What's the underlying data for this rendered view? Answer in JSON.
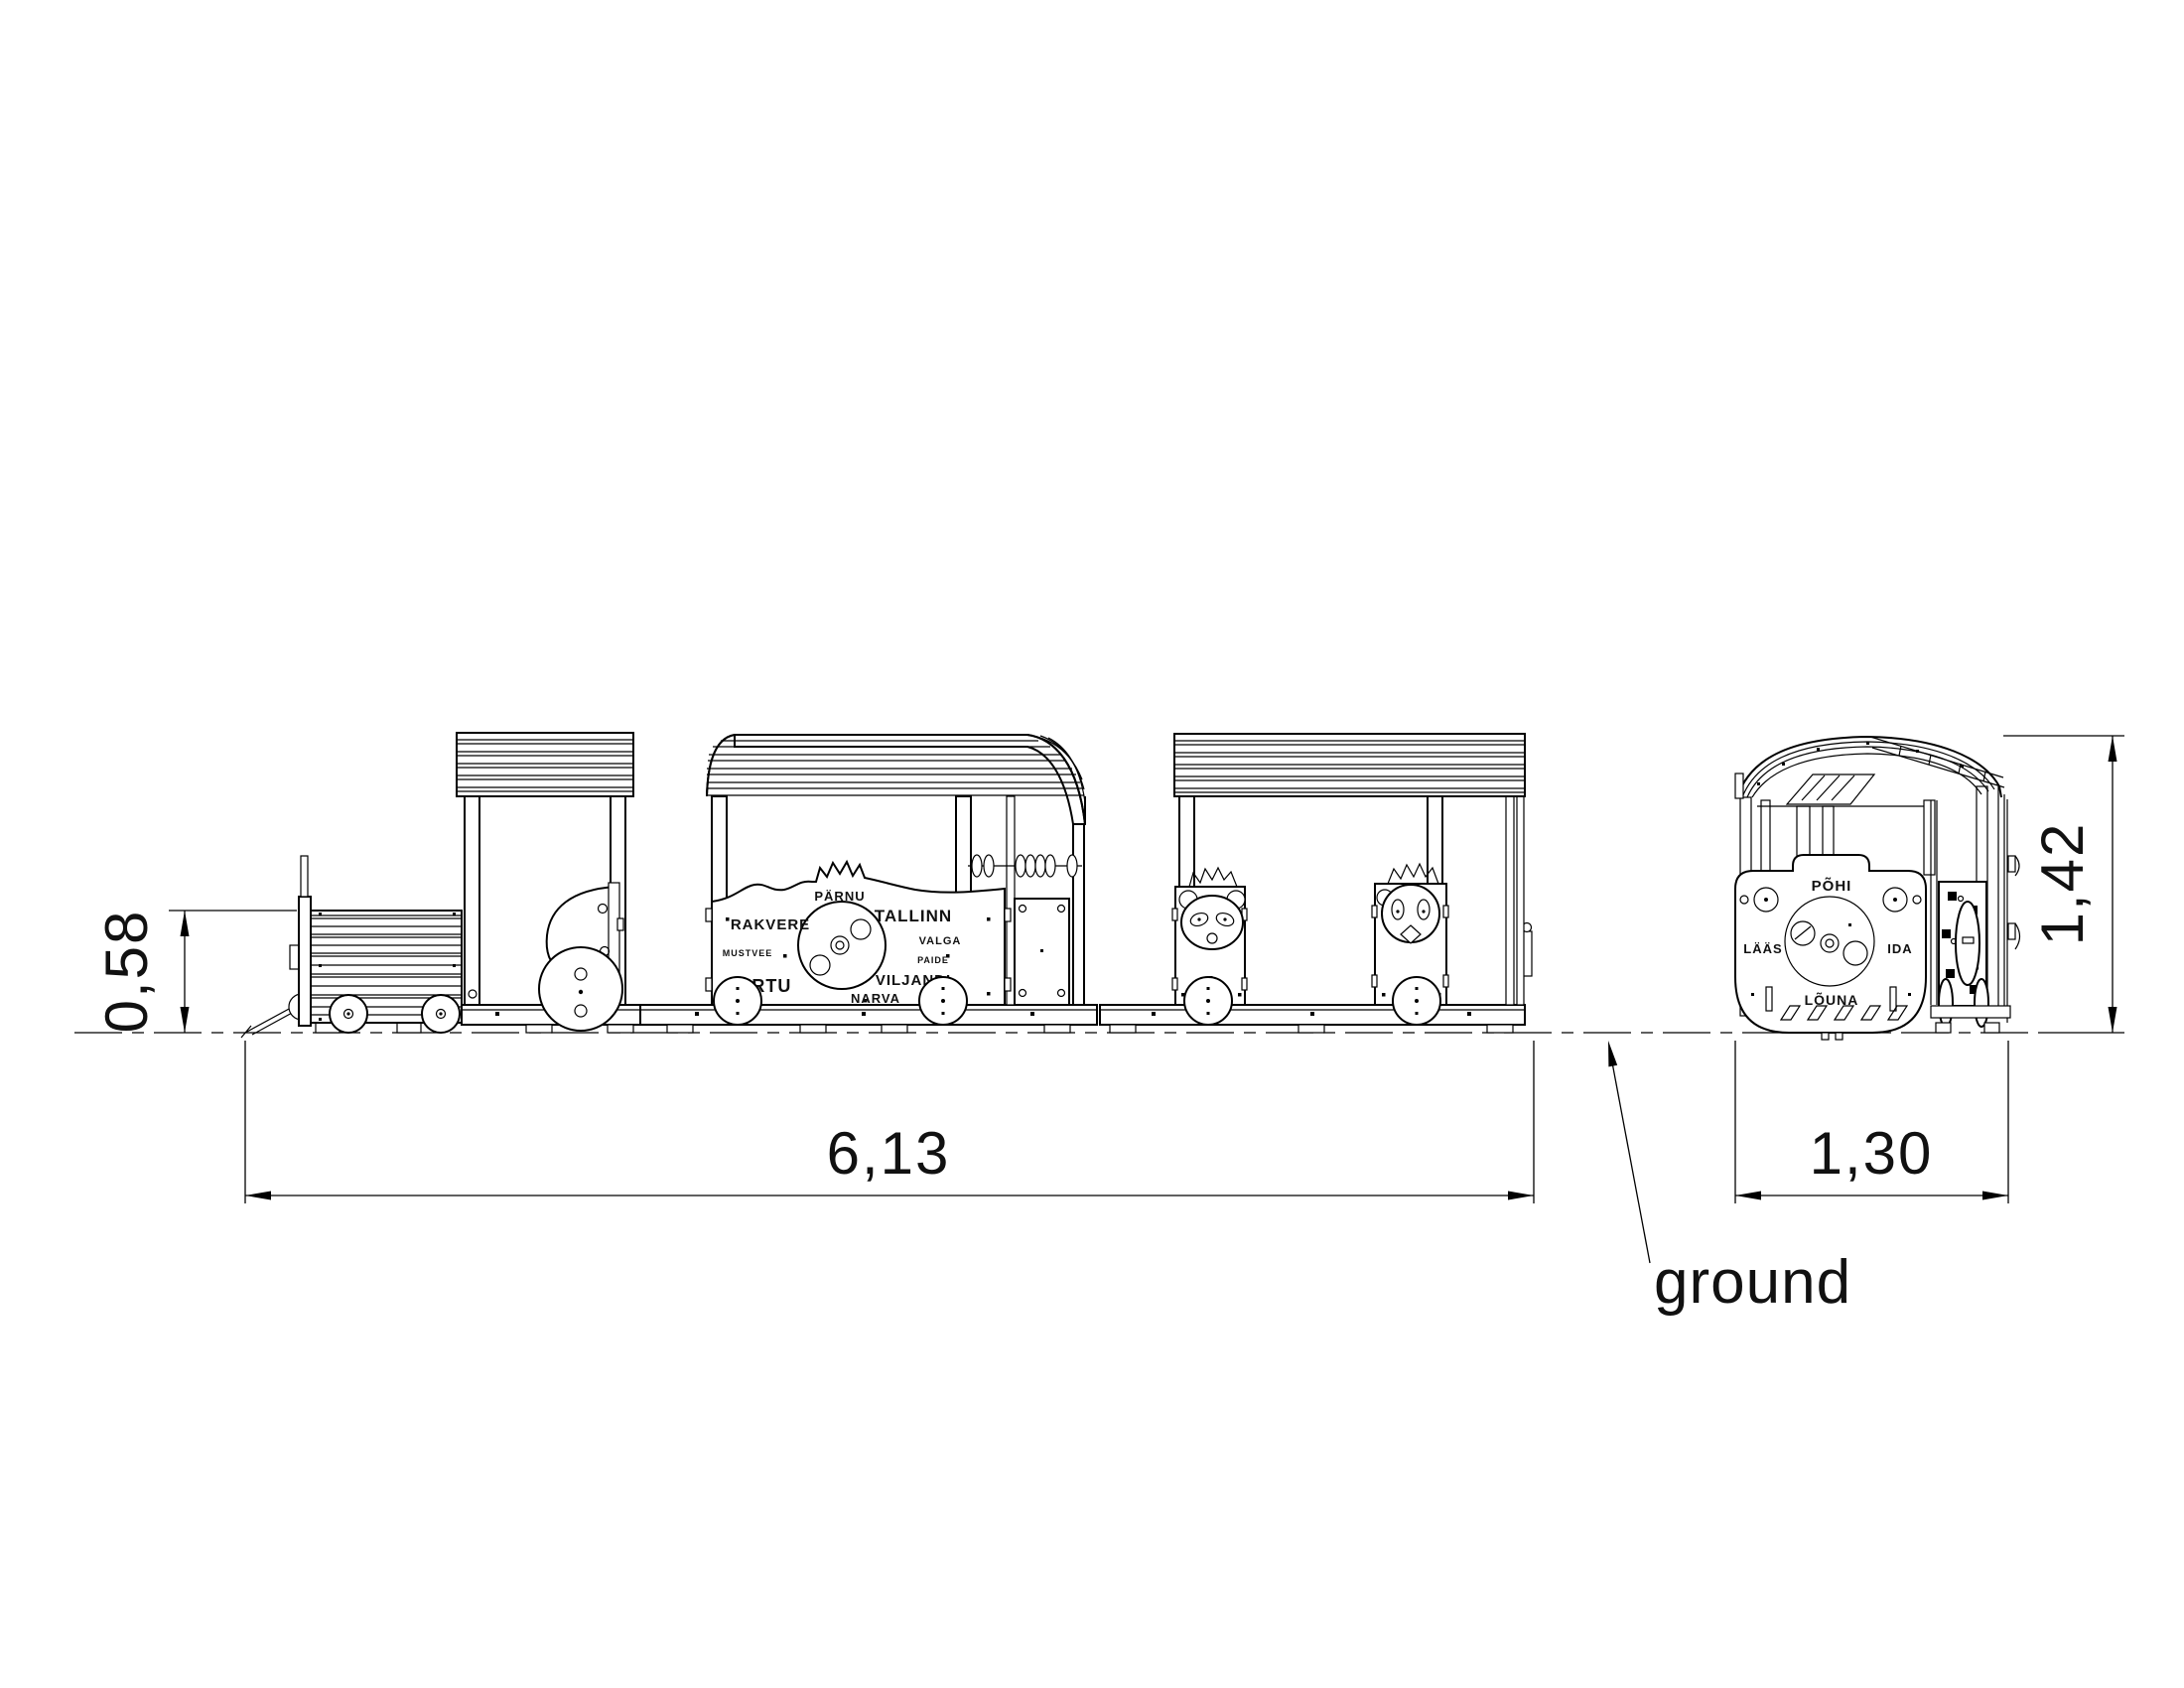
{
  "drawing_type": "playground-train-technical-drawing",
  "colors": {
    "line": "#000000",
    "background": "#ffffff"
  },
  "dims": {
    "boiler_height": "0,58",
    "length": "6,13",
    "width": "1,30",
    "height": "1,42"
  },
  "ground_label": "ground",
  "cities": {
    "parnu": "PÄRNU",
    "rakvere": "RAKVERE",
    "tallinn": "TALLINN",
    "mustvee": "MUSTVEE",
    "valga": "VALGA",
    "paide": "PAIDE",
    "tartu": "TARTU",
    "viljandi": "VILJANDI",
    "narva": "NARVA"
  },
  "compass": {
    "pohi": "PÕHI",
    "laas": "LÄÄS",
    "ida": "IDA",
    "louna": "LÕUNA"
  }
}
